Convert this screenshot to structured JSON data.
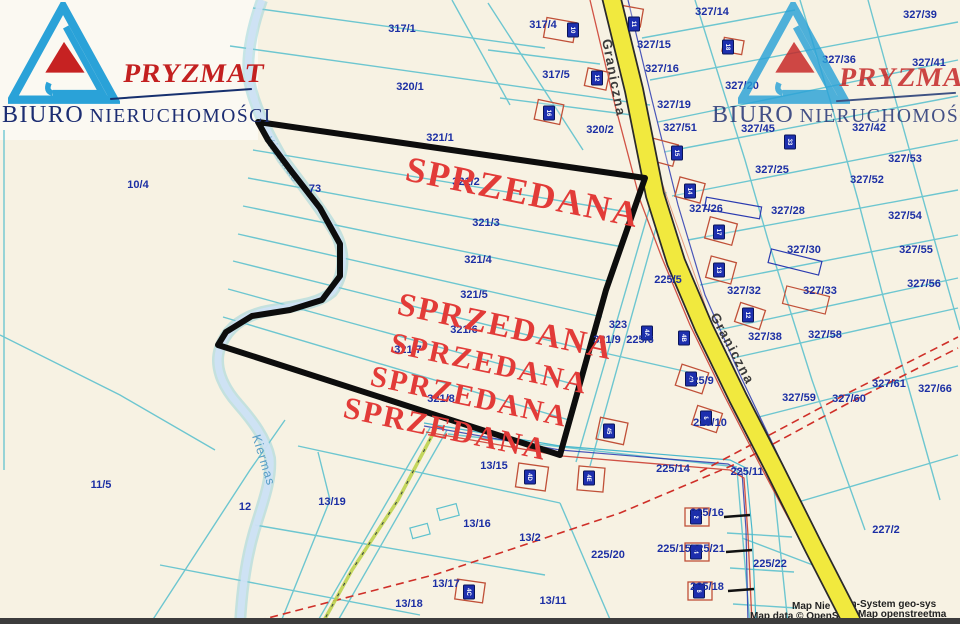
{
  "branding": {
    "company": "PRYZMAT",
    "tagline_word1": "BIURO",
    "tagline_word2": "NIERUCHOMOŚCI"
  },
  "colors": {
    "sold_red": "#e23b38",
    "road_yellow": "#f1e93e",
    "boundary_black": "#0d0d0d",
    "parcel_line_cyan": "#5fc2ce",
    "label_blue": "#1c2fa4",
    "logo_blue": "#2aa2d8",
    "logo_red": "#c62222",
    "logo_navy": "#1c2d72",
    "river_blue": "#cfe2f4"
  },
  "map": {
    "sold_labels": [
      {
        "t": "SPRZEDANA",
        "x": 404,
        "y": 180,
        "r": 11.5,
        "s": 36
      },
      {
        "t": "SPRZEDANA",
        "x": 396,
        "y": 314,
        "r": 12,
        "s": 33
      },
      {
        "t": "SPRZEDANA",
        "x": 389,
        "y": 352,
        "r": 12,
        "s": 30
      },
      {
        "t": "SPRZEDANA",
        "x": 369,
        "y": 385,
        "r": 12,
        "s": 30
      },
      {
        "t": "SPRZEDANA",
        "x": 342,
        "y": 417,
        "r": 12,
        "s": 31
      }
    ],
    "road_labels": [
      {
        "t": "Graniczna",
        "x": 602,
        "y": 40,
        "r": 79
      },
      {
        "t": "Graniczna",
        "x": 710,
        "y": 316,
        "r": 62
      }
    ],
    "river_labels": [
      {
        "t": "Kiermas",
        "x": 264,
        "y": 140,
        "r": 55,
        "faint": true
      },
      {
        "t": "Kiermas",
        "x": 252,
        "y": 436,
        "r": 73
      }
    ],
    "parcel_labels": [
      {
        "t": "317/1",
        "x": 402,
        "y": 32
      },
      {
        "t": "320/1",
        "x": 410,
        "y": 90
      },
      {
        "t": "317/4",
        "x": 543,
        "y": 28
      },
      {
        "t": "317/5",
        "x": 556,
        "y": 78
      },
      {
        "t": "320/2",
        "x": 600,
        "y": 133
      },
      {
        "t": "10/4",
        "x": 138,
        "y": 188
      },
      {
        "t": "73",
        "x": 315,
        "y": 192
      },
      {
        "t": "321/1",
        "x": 440,
        "y": 141
      },
      {
        "t": "321/2",
        "x": 466,
        "y": 185
      },
      {
        "t": "321/3",
        "x": 486,
        "y": 226
      },
      {
        "t": "321/4",
        "x": 478,
        "y": 263
      },
      {
        "t": "321/5",
        "x": 474,
        "y": 298
      },
      {
        "t": "321/6",
        "x": 464,
        "y": 333
      },
      {
        "t": "321/7",
        "x": 408,
        "y": 353
      },
      {
        "t": "321/8",
        "x": 441,
        "y": 402
      },
      {
        "t": "323",
        "x": 618,
        "y": 328
      },
      {
        "t": "321/9",
        "x": 607,
        "y": 343
      },
      {
        "t": "225/6",
        "x": 640,
        "y": 343
      },
      {
        "t": "225/5",
        "x": 668,
        "y": 283
      },
      {
        "t": "225/9",
        "x": 700,
        "y": 384
      },
      {
        "t": "225/10",
        "x": 710,
        "y": 426
      },
      {
        "t": "225/11",
        "x": 747,
        "y": 475
      },
      {
        "t": "225/14",
        "x": 673,
        "y": 472
      },
      {
        "t": "225/15",
        "x": 674,
        "y": 552
      },
      {
        "t": "225/16",
        "x": 707,
        "y": 516
      },
      {
        "t": "225/21",
        "x": 708,
        "y": 552
      },
      {
        "t": "225/18",
        "x": 707,
        "y": 590
      },
      {
        "t": "225/20",
        "x": 608,
        "y": 558
      },
      {
        "t": "225/22",
        "x": 770,
        "y": 567
      },
      {
        "t": "227/2",
        "x": 886,
        "y": 533
      },
      {
        "t": "11/5",
        "x": 101,
        "y": 488
      },
      {
        "t": "12",
        "x": 245,
        "y": 510
      },
      {
        "t": "13/19",
        "x": 332,
        "y": 505
      },
      {
        "t": "13/15",
        "x": 494,
        "y": 469
      },
      {
        "t": "13/16",
        "x": 477,
        "y": 527
      },
      {
        "t": "13/2",
        "x": 530,
        "y": 541
      },
      {
        "t": "13/17",
        "x": 446,
        "y": 587
      },
      {
        "t": "13/11",
        "x": 553,
        "y": 604
      },
      {
        "t": "13/18",
        "x": 409,
        "y": 607
      },
      {
        "t": "327/14",
        "x": 712,
        "y": 15
      },
      {
        "t": "327/39",
        "x": 920,
        "y": 18
      },
      {
        "t": "327/15",
        "x": 654,
        "y": 48
      },
      {
        "t": "327/16",
        "x": 662,
        "y": 72
      },
      {
        "t": "327/36",
        "x": 839,
        "y": 63
      },
      {
        "t": "327/41",
        "x": 929,
        "y": 66
      },
      {
        "t": "327/20",
        "x": 742,
        "y": 89
      },
      {
        "t": "327/19",
        "x": 674,
        "y": 108
      },
      {
        "t": "327/51",
        "x": 680,
        "y": 131
      },
      {
        "t": "327/45",
        "x": 758,
        "y": 132
      },
      {
        "t": "327/42",
        "x": 869,
        "y": 131
      },
      {
        "t": "327/53",
        "x": 905,
        "y": 162
      },
      {
        "t": "327/52",
        "x": 867,
        "y": 183
      },
      {
        "t": "327/25",
        "x": 772,
        "y": 173
      },
      {
        "t": "327/26",
        "x": 706,
        "y": 212
      },
      {
        "t": "327/28",
        "x": 788,
        "y": 214
      },
      {
        "t": "327/54",
        "x": 905,
        "y": 219
      },
      {
        "t": "327/30",
        "x": 804,
        "y": 253
      },
      {
        "t": "327/55",
        "x": 916,
        "y": 253
      },
      {
        "t": "327/32",
        "x": 744,
        "y": 294
      },
      {
        "t": "327/33",
        "x": 820,
        "y": 294
      },
      {
        "t": "327/56",
        "x": 924,
        "y": 287
      },
      {
        "t": "327/38",
        "x": 765,
        "y": 340
      },
      {
        "t": "327/58",
        "x": 825,
        "y": 338
      },
      {
        "t": "327/59",
        "x": 799,
        "y": 401
      },
      {
        "t": "327/60",
        "x": 849,
        "y": 402
      },
      {
        "t": "327/61",
        "x": 889,
        "y": 387
      },
      {
        "t": "327/66",
        "x": 935,
        "y": 392
      }
    ],
    "house_plates": [
      {
        "t": "16",
        "x": 549,
        "y": 113
      },
      {
        "t": "12",
        "x": 597,
        "y": 78
      },
      {
        "t": "10",
        "x": 573,
        "y": 30
      },
      {
        "t": "11",
        "x": 634,
        "y": 24
      },
      {
        "t": "18",
        "x": 728,
        "y": 47
      },
      {
        "t": "33",
        "x": 790,
        "y": 142
      },
      {
        "t": "15",
        "x": 677,
        "y": 153
      },
      {
        "t": "14",
        "x": 690,
        "y": 191
      },
      {
        "t": "17",
        "x": 719,
        "y": 232
      },
      {
        "t": "13",
        "x": 719,
        "y": 270
      },
      {
        "t": "12",
        "x": 748,
        "y": 315
      },
      {
        "t": "4A",
        "x": 647,
        "y": 333
      },
      {
        "t": "4B",
        "x": 684,
        "y": 338
      },
      {
        "t": "40",
        "x": 691,
        "y": 379
      },
      {
        "t": "8",
        "x": 706,
        "y": 418
      },
      {
        "t": "45",
        "x": 609,
        "y": 431
      },
      {
        "t": "4D",
        "x": 530,
        "y": 477
      },
      {
        "t": "4E",
        "x": 589,
        "y": 478
      },
      {
        "t": "4C",
        "x": 469,
        "y": 592
      },
      {
        "t": "2",
        "x": 696,
        "y": 517
      },
      {
        "t": "4",
        "x": 696,
        "y": 552
      },
      {
        "t": "6",
        "x": 699,
        "y": 591
      }
    ],
    "attribution": [
      {
        "t": "Map Nie",
        "x": 792,
        "y": 609
      },
      {
        "t": "en-System geo-sys",
        "x": 845,
        "y": 607
      },
      {
        "t": "Map data © OpenSt",
        "x": 750,
        "y": 619
      },
      {
        "t": "Map openstreetma",
        "x": 858,
        "y": 617
      }
    ]
  }
}
